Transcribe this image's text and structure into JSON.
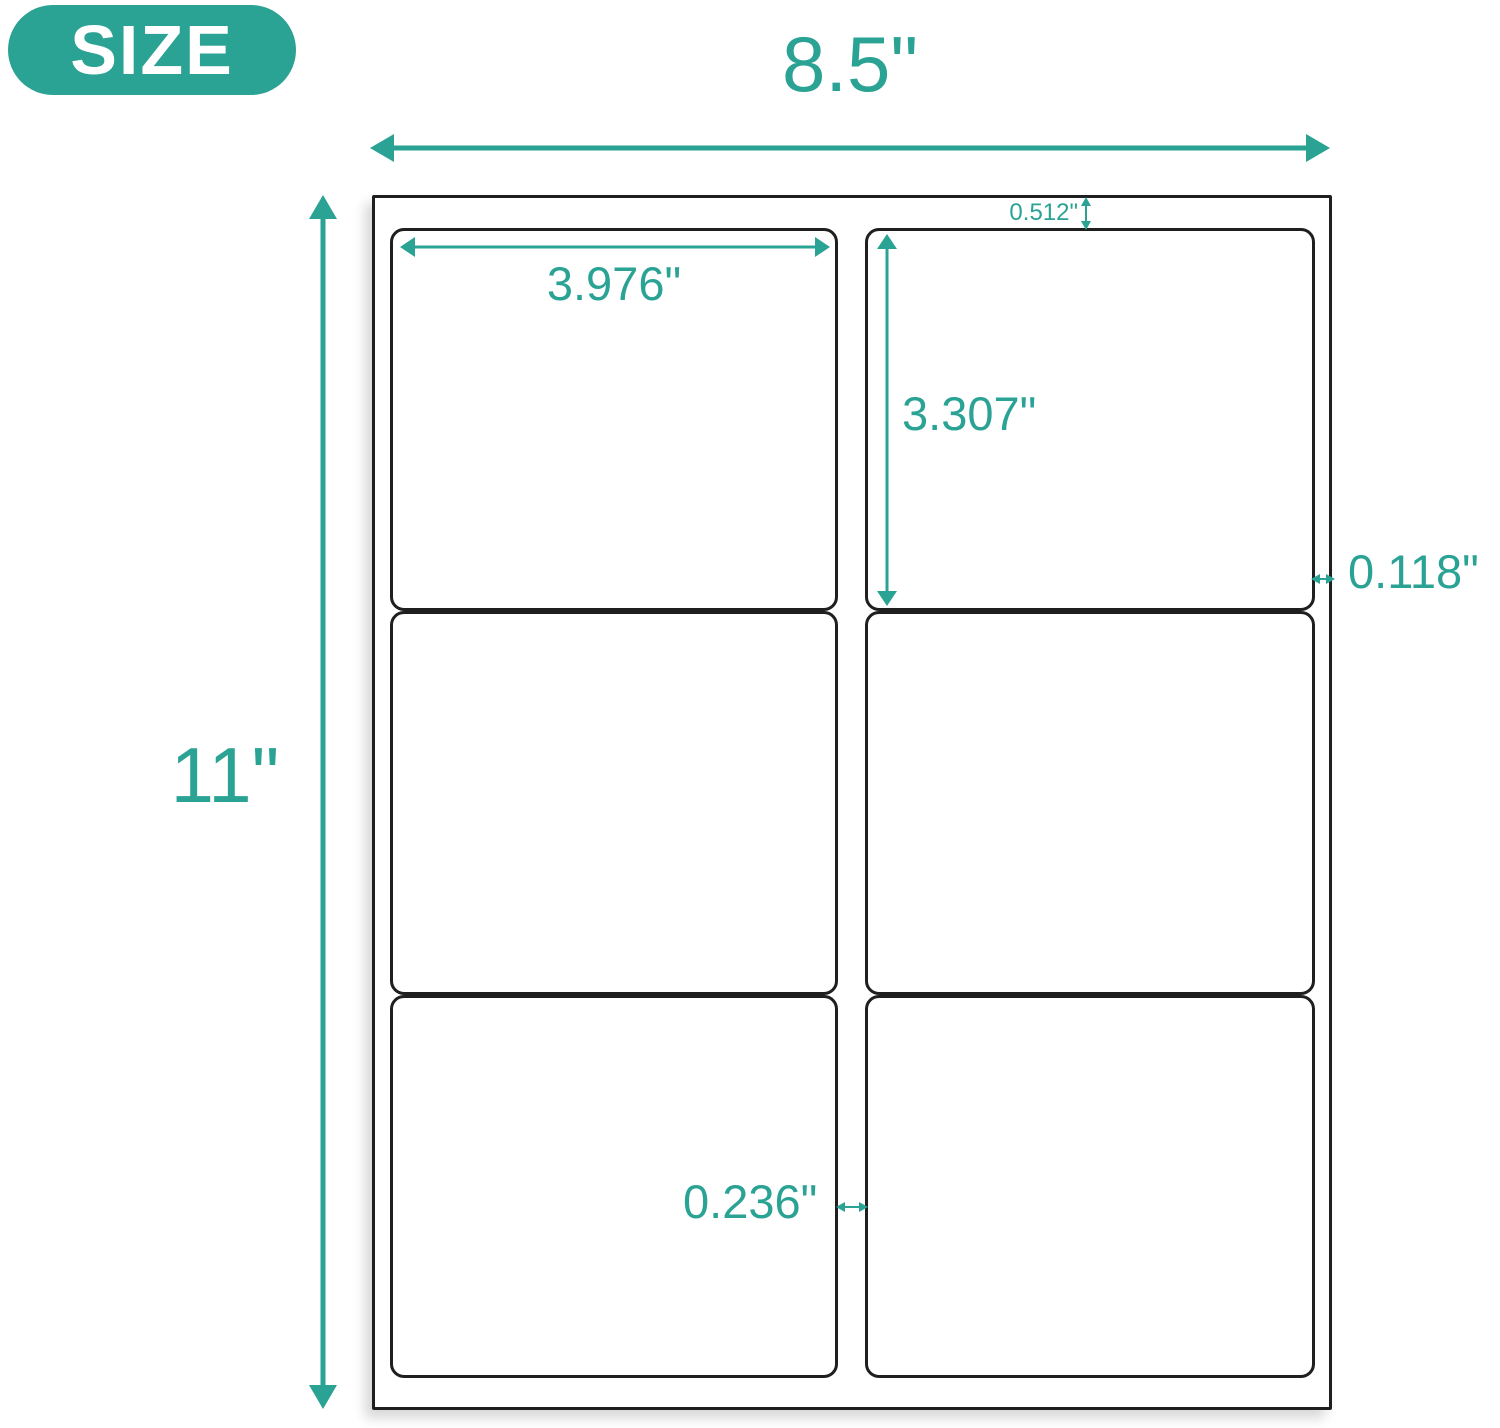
{
  "badge": {
    "label": "SIZE"
  },
  "sheet": {
    "rows": 3,
    "columns": 2,
    "label_count": 6
  },
  "dimensions": {
    "sheet_width": "8.5\"",
    "sheet_height": "11\"",
    "label_width": "3.976\"",
    "label_height": "3.307\"",
    "top_margin": "0.512\"",
    "side_margin": "0.118\"",
    "column_gap": "0.236\""
  },
  "colors": {
    "accent_teal": "#2AA294",
    "outline_black": "#1F1F1F",
    "background": "#FFFFFF"
  }
}
